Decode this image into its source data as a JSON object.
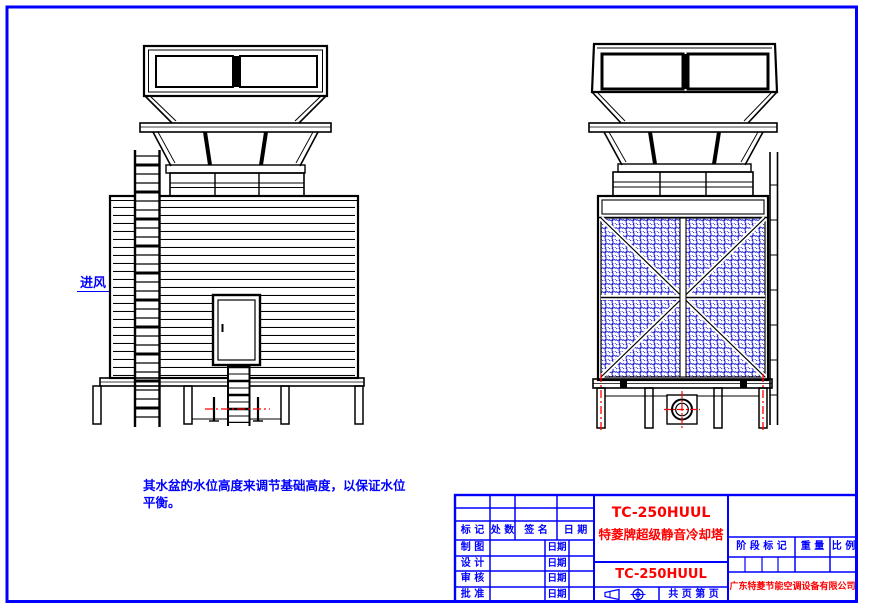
{
  "sheet": {
    "frame_color": "#0000ff",
    "drawing_line_color": "#000000",
    "centerline_color": "#ff0000",
    "mesh_color": "#0000cc",
    "text_blue": "#0000ff",
    "text_red": "#ff0000"
  },
  "annotations": {
    "air_inlet": "进风",
    "note_line1": "其水盆的水位高度来调节基础高度，以保证水位",
    "note_line2": "平衡。"
  },
  "title_block": {
    "revision_columns": [
      "标 记",
      "处 数",
      "签 名",
      "日 期"
    ],
    "signature_rows": [
      {
        "label": "制 图",
        "date": "日期"
      },
      {
        "label": "设 计",
        "date": "日期"
      },
      {
        "label": "审 核",
        "date": "日期"
      },
      {
        "label": "批 准",
        "date": "日期"
      }
    ],
    "model": "TC-250HUUL",
    "product_name": "特菱牌超级静音冷却塔",
    "model_small": "TC-250HUUL",
    "stage_mark": "阶 段 标 记",
    "weight": "重 量",
    "scale": "比 例",
    "pages": "共  页  第  页",
    "company": "广东特菱节能空调设备有限公司"
  }
}
